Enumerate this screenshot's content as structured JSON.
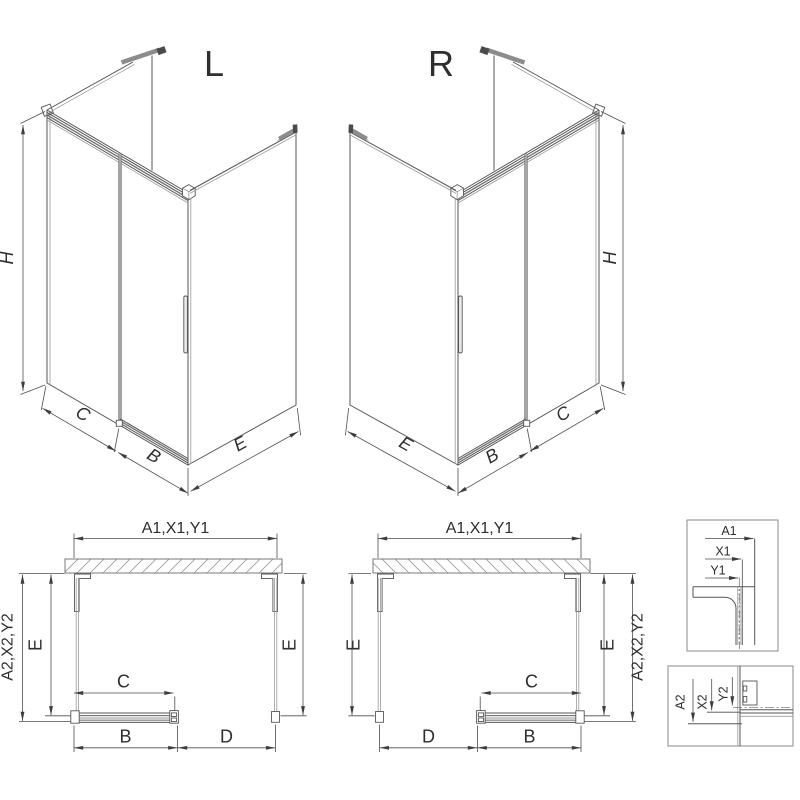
{
  "page": {
    "background": "#ffffff"
  },
  "colors": {
    "line": "#565656",
    "light_line": "#9a9a9a",
    "dim_line": "#4d4d4d",
    "text": "#2e2e2e",
    "hatch": "#9a9a9a",
    "rail_gray": "#8c8c8c"
  },
  "iso_left": {
    "label": "L",
    "dim_height": "H",
    "dim_fixed": "C",
    "dim_door": "B",
    "dim_side": "E"
  },
  "iso_right": {
    "label": "R",
    "dim_height": "H",
    "dim_fixed": "C",
    "dim_door": "B",
    "dim_side": "E"
  },
  "plan_left": {
    "dim_top": "A1,X1,Y1",
    "dim_left_outer": "A2,X2,Y2",
    "dim_left_inner": "E",
    "dim_right_inner": "E",
    "dim_clear": "C",
    "dim_bottom_left": "B",
    "dim_bottom_right": "D"
  },
  "plan_right": {
    "dim_top": "A1,X1,Y1",
    "dim_right_outer": "A2,X2,Y2",
    "dim_left_inner": "E",
    "dim_right_inner": "E",
    "dim_clear": "C",
    "dim_bottom_left": "D",
    "dim_bottom_right": "B"
  },
  "detail_top": {
    "dim_a": "A1",
    "dim_x": "X1",
    "dim_y": "Y1"
  },
  "detail_bottom": {
    "dim_a": "A2",
    "dim_x": "X2",
    "dim_y": "Y2"
  }
}
